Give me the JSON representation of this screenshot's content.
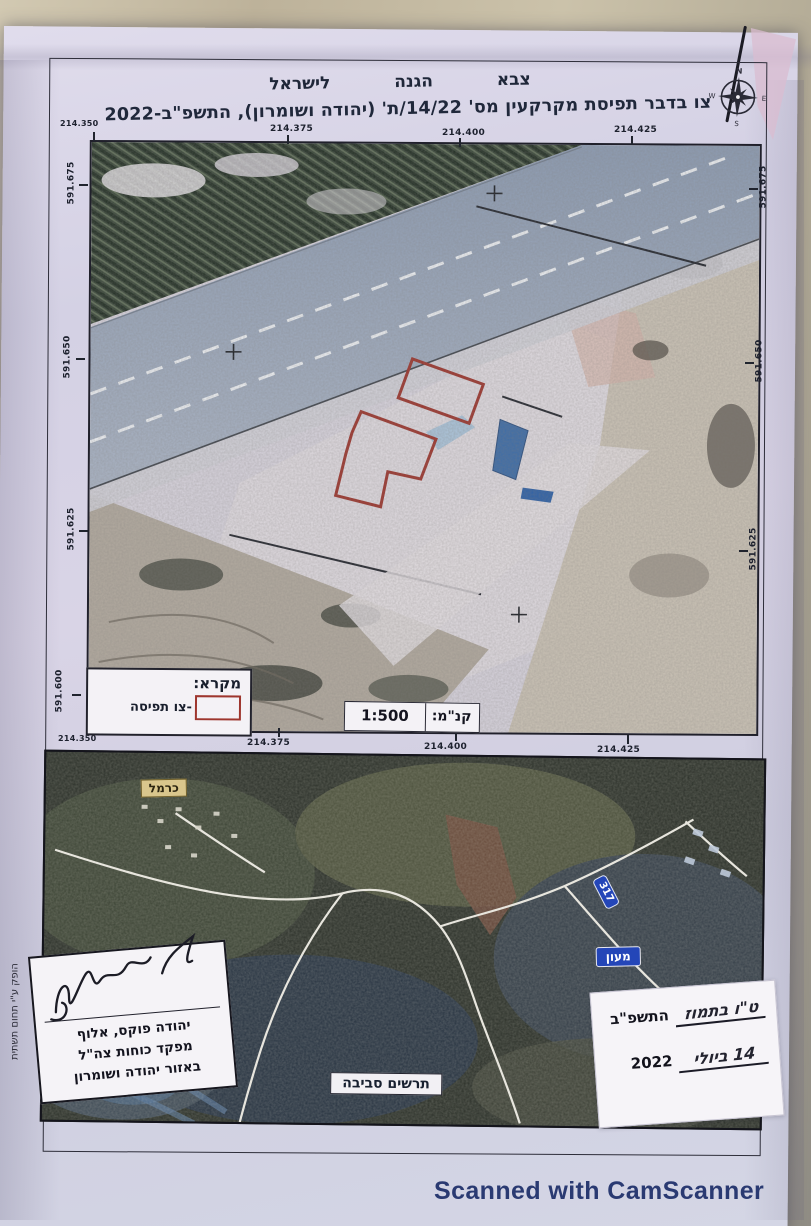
{
  "document": {
    "army_line": "צבא הגנה לישראל",
    "title": "צו בדבר תפיסת מקרקעין מס' 14/22/ת' (יהודה ושומרון), התשפ\"ב-2022"
  },
  "compass": {
    "north": "N",
    "east": "E",
    "south": "S",
    "west": "W"
  },
  "main_map": {
    "top_coords": [
      "214.350",
      "214.375",
      "214.400",
      "214.425"
    ],
    "bottom_coords": [
      "214.350",
      "214.375",
      "214.400",
      "214.425"
    ],
    "left_coords": [
      "591.675",
      "591.650",
      "591.625",
      "591.600"
    ],
    "right_coords": [
      "591.675",
      "591.650",
      "591.625"
    ],
    "legend_title": "מקרא:",
    "legend_item": "-צו תפיסה",
    "scale_label": "קנ\"מ:",
    "scale_value": "1:500"
  },
  "overview_map": {
    "place_carmel": "כרמל",
    "place_maon": "מעון",
    "road_number": "317",
    "caption": "תרשים סביבה"
  },
  "signature_block": {
    "line1": "יהודה פוקס, אלוף",
    "line2": "מפקד כוחות צה\"ל",
    "line3": "באזור יהודה ושומרון"
  },
  "date_block": {
    "line1_handwritten": "ט\"ו בתמוז",
    "line1_printed": "התשפ\"ב",
    "line2_handwritten": "14 ביולי",
    "line2_printed": "2022"
  },
  "margin_note": "הופק ע\"י תחום תשתית",
  "watermark": "Scanned with CamScanner",
  "colors": {
    "seizure_outline": "#9e362e",
    "camscanner_text": "#2a3a72",
    "road_sign_blue": "#2446b8",
    "carmel_label_bg": "#d9c68c",
    "paper": "#d6d3e6"
  }
}
